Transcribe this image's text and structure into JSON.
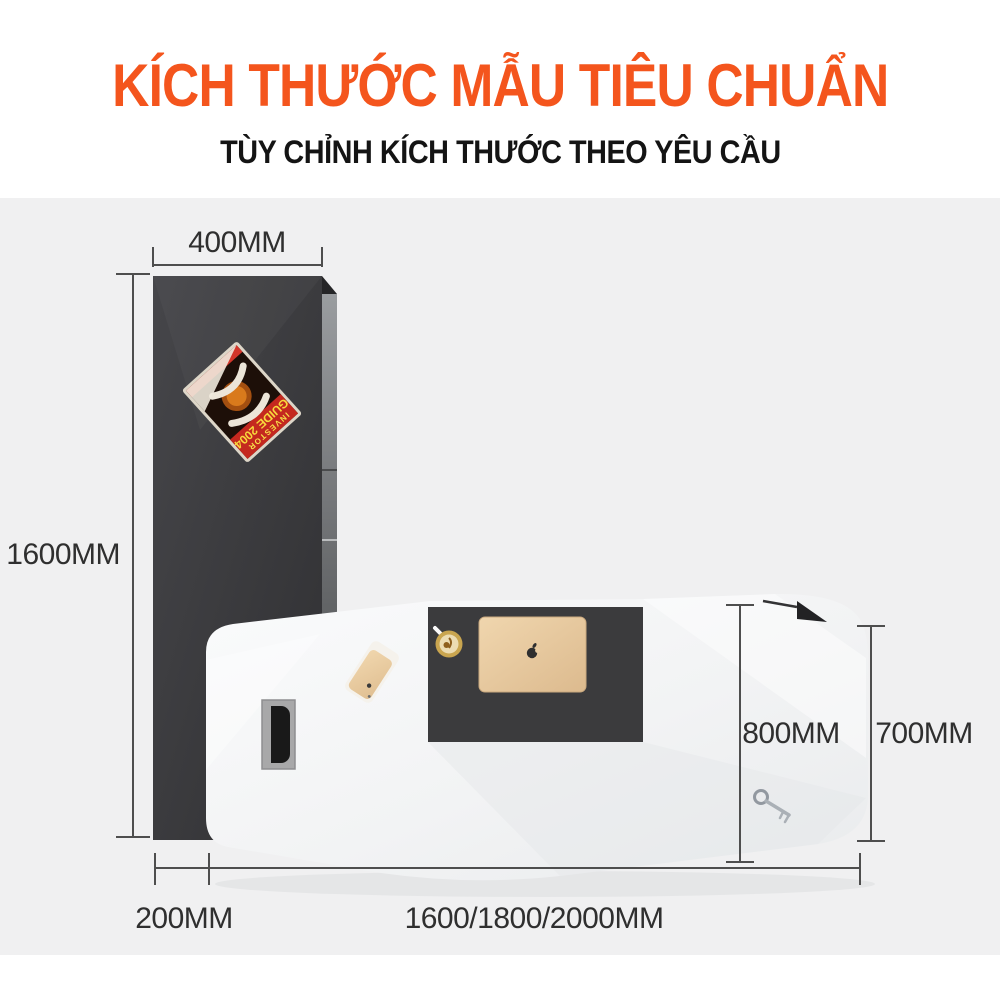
{
  "header": {
    "title": "KÍCH THƯỚC MẪU TIÊU CHUẨN",
    "subtitle": "TÙY CHỈNH KÍCH THƯỚC THEO YÊU CẦU"
  },
  "dimensions": {
    "top_width": "400MM",
    "left_height": "1600MM",
    "desk_depth": "800MM",
    "right_height": "700MM",
    "bottom_offset": "200MM",
    "bottom_span": "1600/1800/2000MM"
  },
  "magazine": {
    "line1": "INVESTOR",
    "line2": "GUIDE 2004"
  },
  "colors": {
    "accent": "#f4551d",
    "background_band": "#f0f0f1",
    "cabinet_front": "#3c3c3e",
    "desk_pad": "#3b3b3d",
    "laptop_gold": "#e8cba1",
    "dimension_line": "#4e4e4e"
  }
}
